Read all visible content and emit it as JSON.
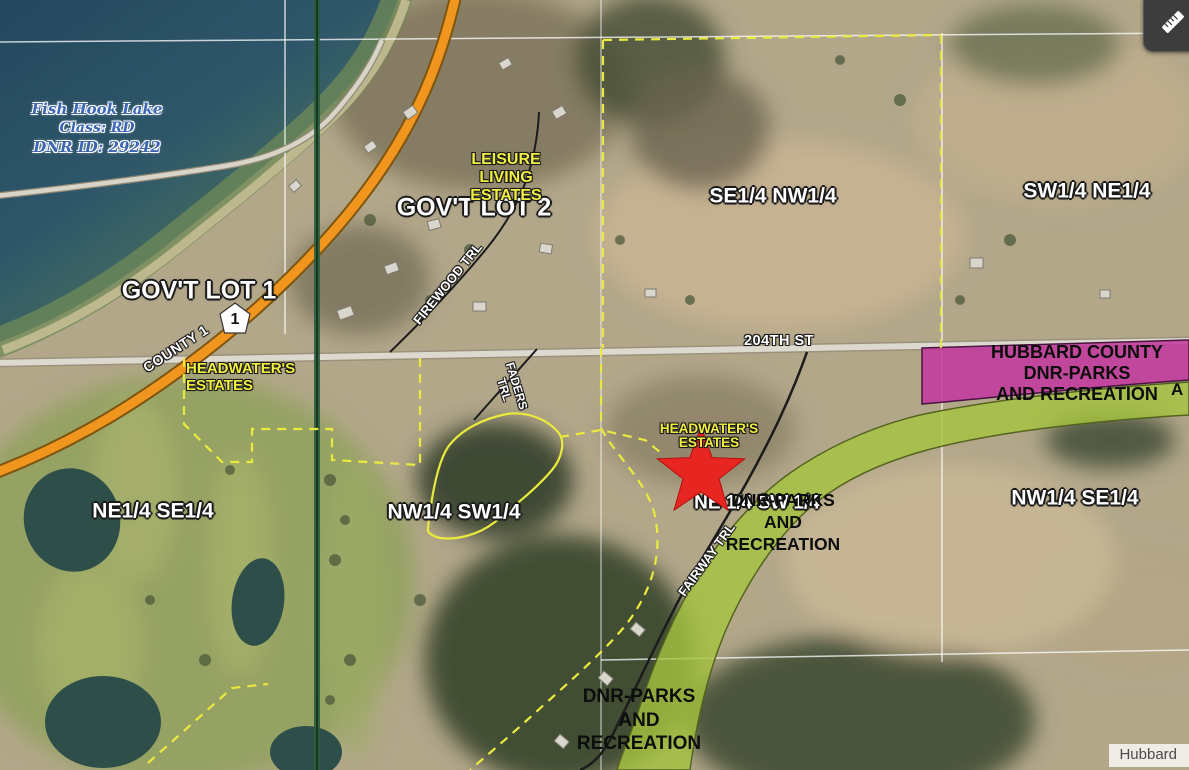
{
  "map_labels": {
    "lake": {
      "name": "Fish Hook Lake",
      "lake_class": "Class: RD",
      "dnr_id": "DNR ID: 29242"
    },
    "govt_lot_1": "GOV'T LOT 1",
    "govt_lot_2": "GOV'T LOT 2",
    "leisure_living_estates": {
      "line1": "LEISURE",
      "line2": "LIVING",
      "line3": "ESTATES"
    },
    "headwaters_estates_west": {
      "line1": "HEADWATER'S",
      "line2": "ESTATES"
    },
    "headwaters_estates_central": {
      "line1": "HEADWATER'S",
      "line2": "ESTATES"
    },
    "quarters": {
      "se_nw": "SE1/4 NW1/4",
      "sw_ne": "SW1/4 NE1/4",
      "ne_se": "NE1/4 SE1/4",
      "nw_sw": "NW1/4 SW1/4",
      "ne_sw": "NE 1/4 SW 1/4",
      "nw_se": "NW1/4 SE1/4"
    },
    "roads": {
      "county_shield": "1",
      "county_1": "COUNTY 1",
      "st_204th": "204TH ST",
      "firewood": "FIREWOOD TRL",
      "faders": {
        "line1": "FADERS",
        "line2": "TRL"
      },
      "fairway": "FAIRWAY TRL"
    },
    "ownership": {
      "hubbard_county_parcel": {
        "line1": "HUBBARD COUNTY",
        "line2": "DNR-PARKS",
        "line3": "AND RECREATION"
      },
      "central_parcel": {
        "line1": "DNR-PARKS",
        "line2": "AND",
        "line3": "RECREATION"
      },
      "south_parcel": {
        "line1": "DNR-PARKS",
        "line2": "AND",
        "line3": "RECREATION"
      },
      "edge_partial": "A"
    },
    "attribution": "Hubbard"
  },
  "colors": {
    "water_deep": "#2a5064",
    "highway_orange": "#f0961e",
    "parcel_line_yellow": "#eaea3e",
    "trail_parcel_green": "#a5c43e",
    "county_parcel_magenta": "#c13a9d",
    "marker_red": "#e72621",
    "label_yellow": "#f0ee41",
    "label_blue": "#3c66b4"
  },
  "icons": {
    "measure": "ruler-icon",
    "marker": "star-icon"
  }
}
